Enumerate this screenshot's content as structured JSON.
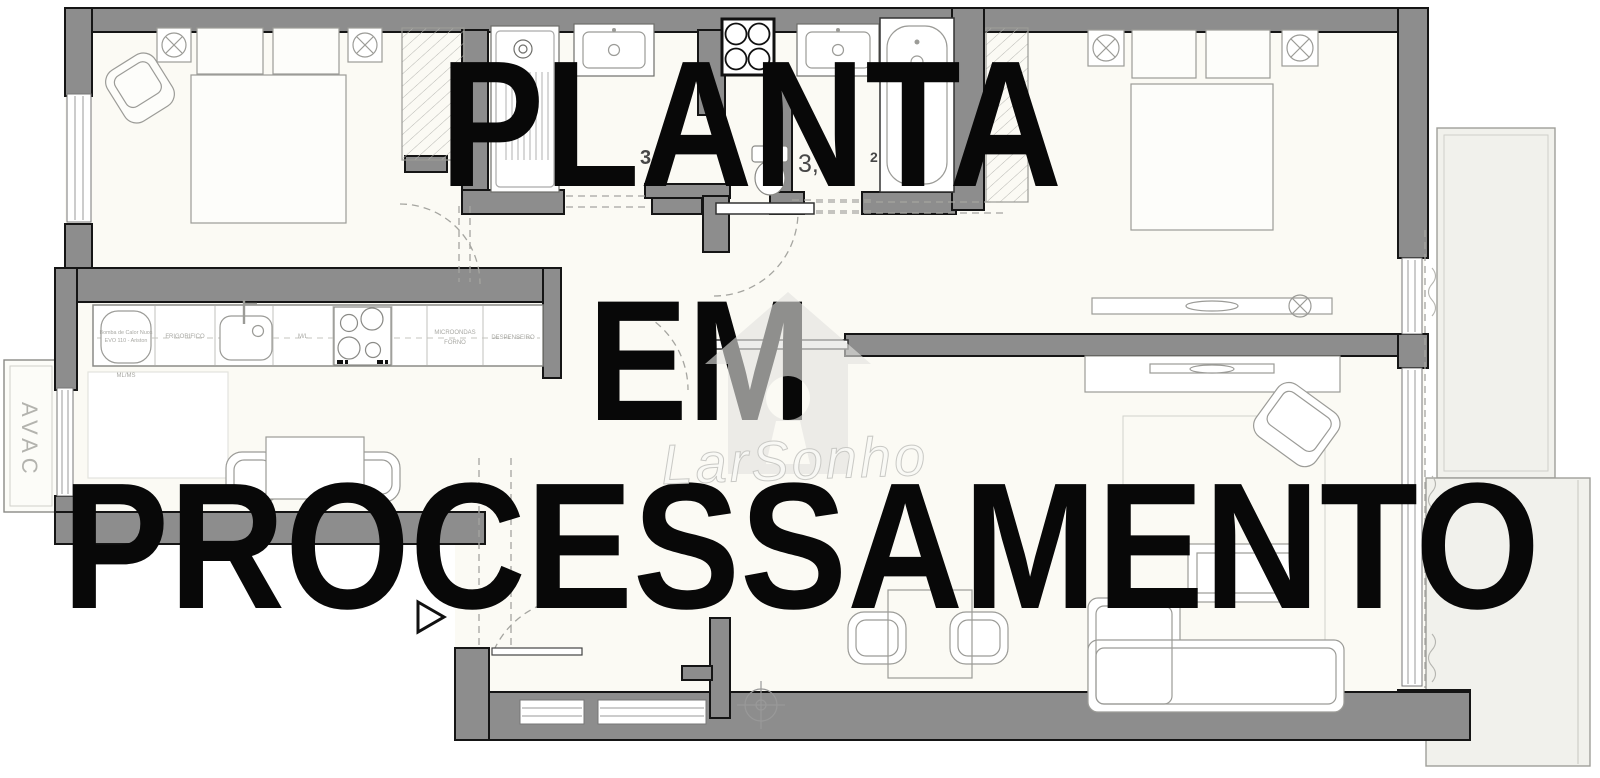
{
  "watermark": {
    "line1": "PLANTA",
    "line2": "EM",
    "line3": "PROCESSAMENTO"
  },
  "logo": {
    "brand_script": "LarSonho"
  },
  "labels": {
    "avac": "AVAC",
    "kitchen": {
      "heat_pump_line1": "Bomba de Calor Nuos",
      "heat_pump_line2": "EVO 110 - Ariston",
      "fridge": "FRIGORIFICO",
      "washer": "M/L",
      "microwave": "MICROONDAS",
      "oven": "FORNO",
      "pantry": "DESPENSEIRO",
      "under_counter": "ML/MS"
    },
    "areas": {
      "bath1_fragment": "3",
      "bath2_fragment": "3,",
      "bath2_superscript": "2"
    }
  },
  "colors": {
    "wall": "#8d8d8d",
    "wall_outline": "#151515",
    "floor": "#fbfaf4",
    "balcony": "#f1f1ec",
    "furniture_line": "#9b9b97",
    "watermark_text": "#080808",
    "logo_tint": "#e2e2df"
  }
}
